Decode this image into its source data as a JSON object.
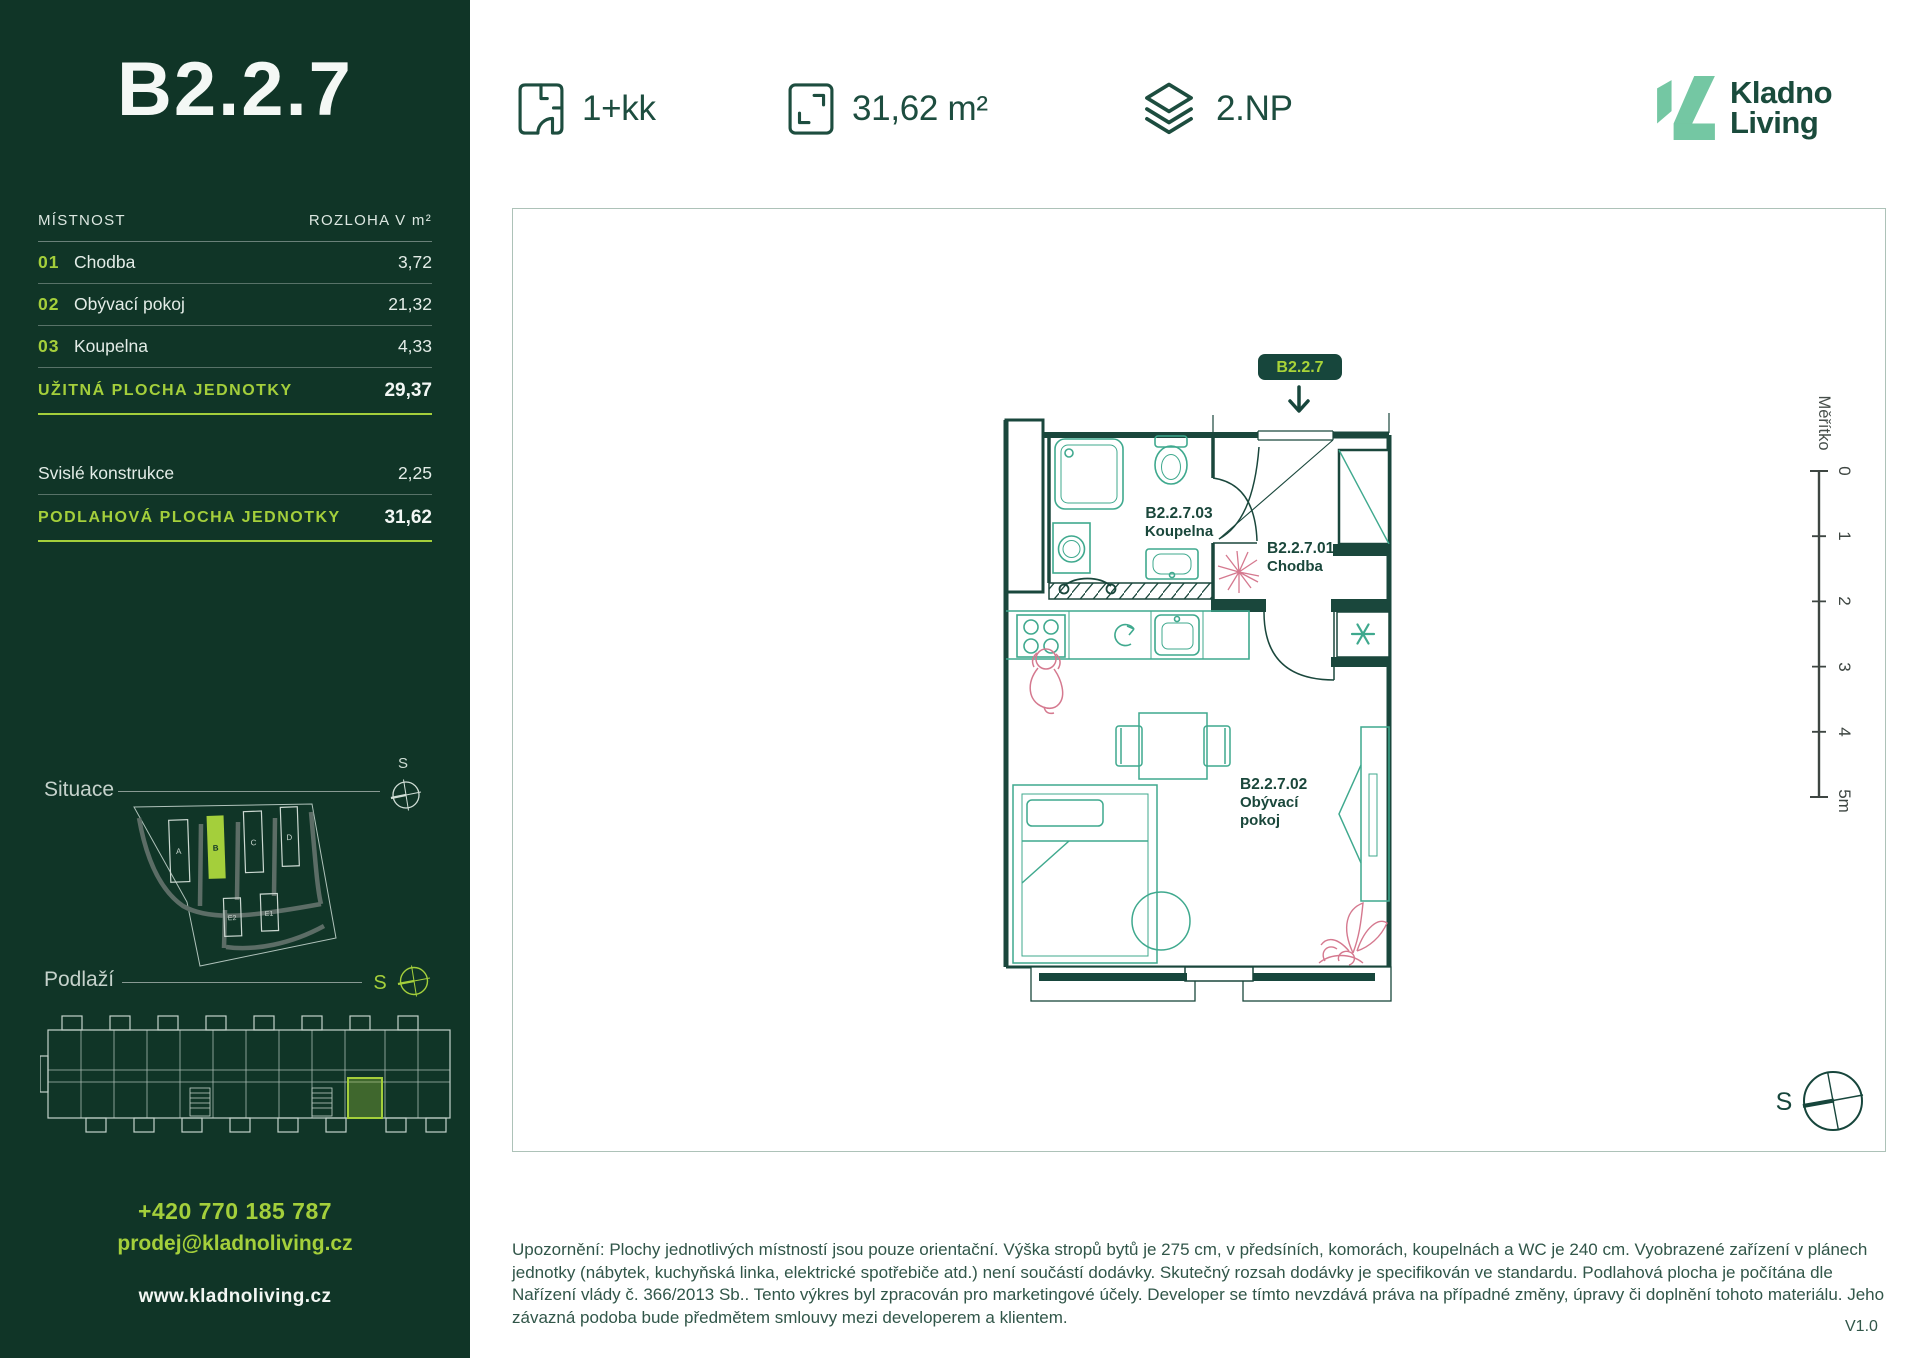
{
  "colors": {
    "brand_dark_green": "#103527",
    "accent_lime": "#A4CF3B",
    "logo_mint": "#74C7A3",
    "ink_green": "#1A473C",
    "furniture_teal": "#3FA98E",
    "decor_pink": "#D5798F"
  },
  "sidebar": {
    "unit_title": "B2.2.7",
    "table": {
      "col_room": "MÍSTNOST",
      "col_area": "ROZLOHA V m²",
      "rows": [
        {
          "num": "01",
          "name": "Chodba",
          "area": "3,72"
        },
        {
          "num": "02",
          "name": "Obývací pokoj",
          "area": "21,32"
        },
        {
          "num": "03",
          "name": "Koupelna",
          "area": "4,33"
        }
      ],
      "usable_label": "UŽITNÁ PLOCHA JEDNOTKY",
      "usable_value": "29,37",
      "structures_label": "Svislé konstrukce",
      "structures_value": "2,25",
      "floor_label": "PODLAHOVÁ PLOCHA JEDNOTKY",
      "floor_value": "31,62"
    },
    "situace": {
      "label": "Situace",
      "compass": "S",
      "buildings": [
        "A",
        "B",
        "C",
        "D",
        "E2",
        "E1"
      ]
    },
    "podlazi": {
      "label": "Podlaží",
      "compass": "S"
    },
    "contact": {
      "phone": "+420 770 185 787",
      "email": "prodej@kladnoliving.cz",
      "web": "www.kladnoliving.cz"
    }
  },
  "header": {
    "specs": [
      {
        "icon": "unit-layout-icon",
        "label": "1+kk"
      },
      {
        "icon": "area-icon",
        "label": "31,62 m²"
      },
      {
        "icon": "floor-level-icon",
        "label": "2.NP"
      }
    ],
    "logo": {
      "line1": "Kladno",
      "line2": "Living"
    }
  },
  "plan": {
    "badge": "B2.2.7",
    "rooms": {
      "bathroom": {
        "code": "B2.2.7.03",
        "name": "Koupelna"
      },
      "hall": {
        "code": "B2.2.7.01",
        "name": "Chodba"
      },
      "living": {
        "code": "B2.2.7.02",
        "name_line1": "Obývací",
        "name_line2": "pokoj"
      }
    },
    "scale": {
      "label": "Měřítko",
      "ticks": [
        "0",
        "1",
        "2",
        "3",
        "4",
        "5m"
      ]
    },
    "compass": "S"
  },
  "footer": {
    "disclaimer": "Upozornění: Plochy jednotlivých místností jsou pouze orientační. Výška stropů bytů je 275 cm, v předsíních, komorách, koupelnách a WC je 240 cm. Vyobrazené zařízení v plánech jednotky (nábytek, kuchyňská linka, elektrické spotřebiče atd.) není součástí dodávky. Skutečný rozsah dodávky je specifikován ve standardu. Podlahová plocha je počítána dle Nařízení vlády č. 366/2013 Sb.. Tento výkres byl zpracován pro marketingové účely. Developer se tímto nevzdává práva na případné změny, úpravy či doplnění tohoto materiálu. Jeho závazná podoba bude předmětem smlouvy mezi developerem a klientem.",
    "version": "V1.0"
  }
}
